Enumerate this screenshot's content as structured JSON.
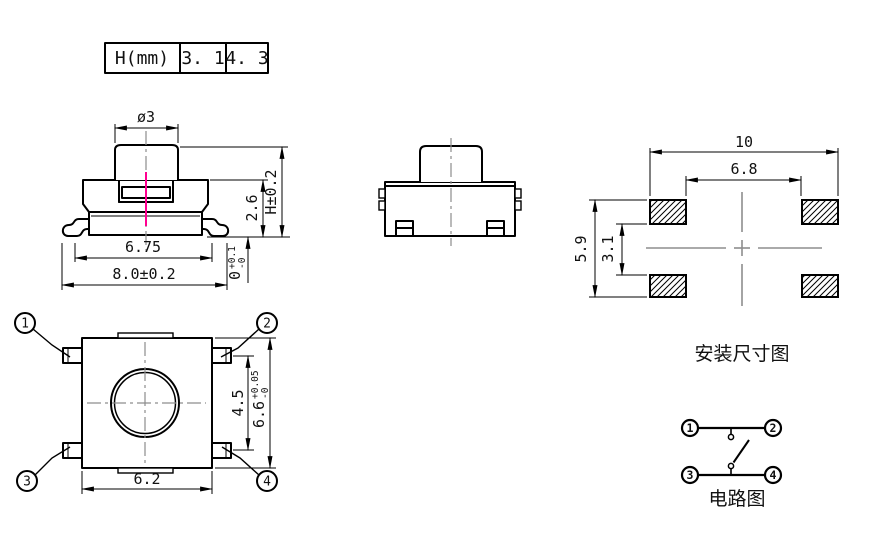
{
  "colors": {
    "accent": "#ff0090",
    "centerline": "#8d8d8d",
    "ink": "#000000"
  },
  "table": {
    "header": "H(mm)",
    "h1": "3. 1",
    "h2": "4. 3"
  },
  "front": {
    "dia": "ø3",
    "step": "2.6",
    "height": "H±0.2",
    "inner_width": "6.75",
    "outer_width": "8.0±0.2",
    "standoff": {
      "value": "0",
      "plus": "+0.1",
      "minus": "-0"
    }
  },
  "top": {
    "pin1": "1",
    "pin2": "2",
    "pin3": "3",
    "pin4": "4",
    "pitch": "4.5",
    "body_len": {
      "value": "6.6",
      "plus": "+0.05",
      "minus": "-0"
    },
    "body_width": "6.2"
  },
  "mount": {
    "outer_width": "10",
    "inner_width": "6.8",
    "outer_height": "5.9",
    "inner_height": "3.1",
    "label": "安装尺寸图"
  },
  "circuit": {
    "pin1": "1",
    "pin2": "2",
    "pin3": "3",
    "pin4": "4",
    "label": "电路图"
  }
}
